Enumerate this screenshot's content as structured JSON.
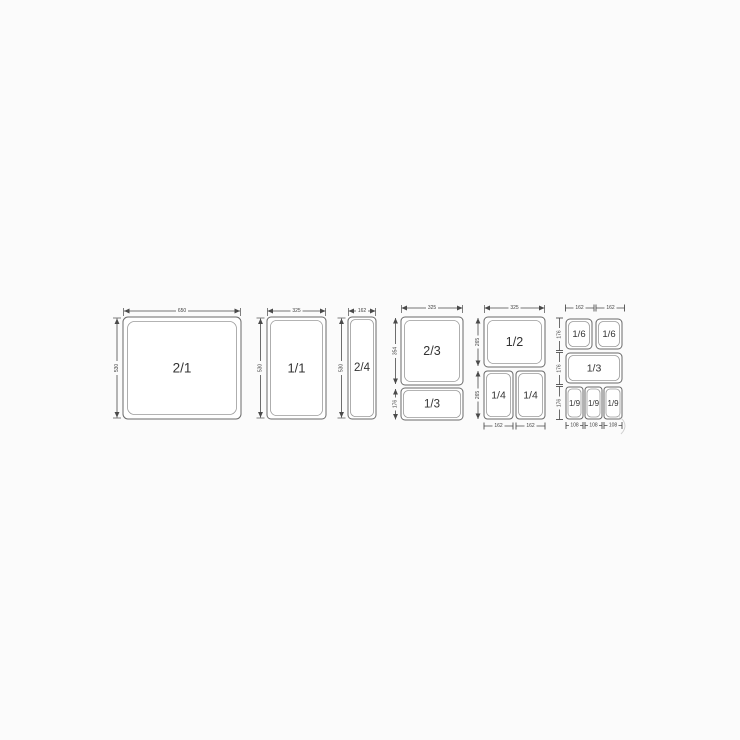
{
  "diagram": {
    "subject": "gastronorm-pan-sizes",
    "colors": {
      "background": "#fbfbfb",
      "pan_fill": "#ffffff",
      "pan_border": "#696969",
      "pan_inner_border": "#9b9b9b",
      "dimension_line": "#4a4a4a",
      "label_text": "#333333"
    },
    "panels": {
      "gn21": {
        "label": "2/1",
        "width_dim": "650",
        "height_dim": "530"
      },
      "gn11": {
        "label": "1/1",
        "width_dim": "325",
        "height_dim": "530"
      },
      "gn24": {
        "label": "2/4",
        "width_dim": "162",
        "height_dim": "530"
      },
      "gn23_13": {
        "width_dim": "325",
        "top_pan": {
          "label": "2/3",
          "height_dim": "354"
        },
        "bottom_pan": {
          "label": "1/3",
          "height_dim": "176"
        }
      },
      "gn12_14": {
        "width_dim": "325",
        "top_pan": {
          "label": "1/2",
          "height_dim": "265"
        },
        "bottom_row_height_dim": "265",
        "bottom_left_pan": {
          "label": "1/4",
          "width_dim": "162"
        },
        "bottom_right_pan": {
          "label": "1/4",
          "width_dim": "162"
        }
      },
      "gn16_13_19": {
        "top_dims": [
          "162",
          "162"
        ],
        "left_dims": [
          "176",
          "176",
          "176"
        ],
        "bottom_dims": [
          "108",
          "108",
          "108"
        ],
        "pans": [
          {
            "label": "1/6"
          },
          {
            "label": "1/6"
          },
          {
            "label": "1/3"
          },
          {
            "label": "1/9"
          },
          {
            "label": "1/9"
          },
          {
            "label": "1/9"
          }
        ]
      }
    }
  }
}
